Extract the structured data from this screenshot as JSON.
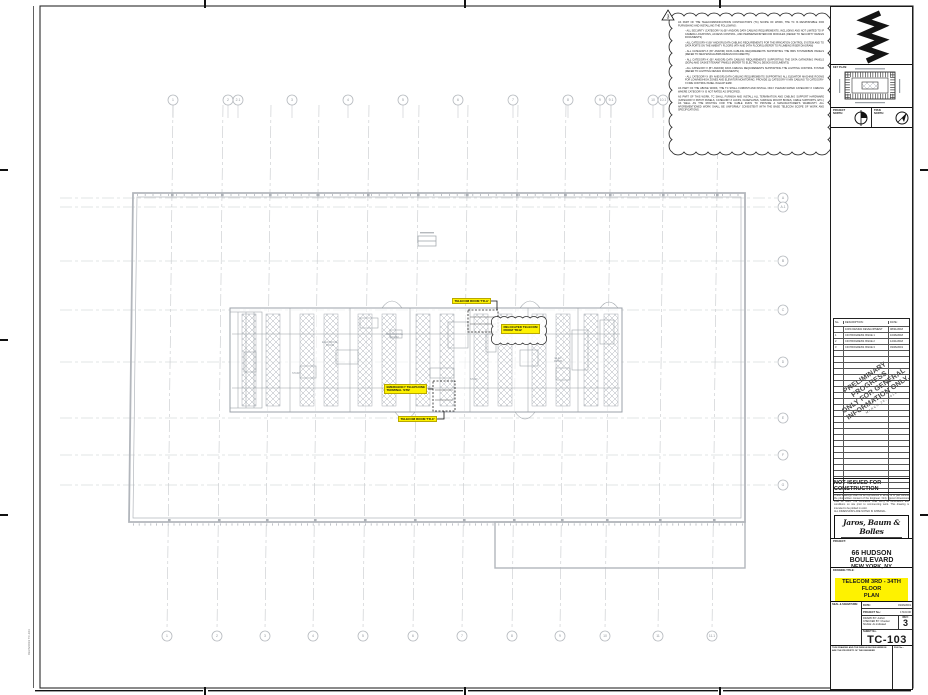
{
  "sheet": {
    "project_label": "PROJECT:",
    "project_name": "66 HUDSON BOULEVARD",
    "project_location": "NEW YORK, NY",
    "drawing_title_label": "DRAWING TITLE:",
    "drawing_title": "TELECOM 3RD - 34TH FLOOR\nPLAN",
    "sheet_no_label": "SHEET No.",
    "sheet_no": "TC-103",
    "rev_label": "REV:",
    "rev": "3",
    "date_label": "DATE:",
    "date_value": "03/26/2019",
    "project_no_label": "PROJECT No.:",
    "project_no_value": "17103.00",
    "drawn_line": "DRAWN BY: Author",
    "checked_line": "CHECKED BY: Checker",
    "scale_line": "SCALE: As indicated",
    "seal_label": "SEAL & SIGNATURE:",
    "not_issued": "NOT ISSUED FOR CONSTRUCTION",
    "disclaimer": "These drawings shall not be reproduced in whole or in part without the prior written consent of the Engineer. Only figured dimensions shall be used. The Contractor shall verify all dimensions and conditions on site prior to commencing work. This drawing is intended to be plotted in color.\nALL DIMENSIONS ARE NOTED IN IMPERIAL.",
    "key_plan_label": "KEY PLAN:",
    "project_north_label": "PROJECT\nNORTH:",
    "true_north_label": "TRUE\nNORTH:",
    "footer_left": "THIS DRAWING AND THE DESIGN SHOWN HEREON ARE THE PROPERTY OF THE ENGINEER",
    "footer_right": "FILE No.:",
    "plot_stamp": "03/26/2019  TC-103"
  },
  "engineer": {
    "name": "Jaros, Baum & Bolles",
    "line2": "CONSULTING ENGINEERS",
    "line3": "NEW YORK, NY"
  },
  "revision_table": {
    "headers": [
      "No.",
      "DESCRIPTION:",
      "DATE:"
    ],
    "rows": [
      [
        "",
        "100% DESIGN DEVELOPMENT",
        "08/31/2018"
      ],
      [
        "1",
        "CD PROGRESS ISSUE 1",
        "10/26/2018"
      ],
      [
        "2",
        "CD PROGRESS ISSUE 2",
        "12/21/2018"
      ],
      [
        "3",
        "CD PROGRESS ISSUE 3",
        "03/26/2019"
      ]
    ],
    "empty_row_count": 25
  },
  "watermark": {
    "lines": [
      "PRELIMINARY PROGRESS",
      "ONLY FOR GENERAL",
      "INFORMATION ONLY."
    ],
    "subline": "MARCH 26, 2019"
  },
  "cloud_note": {
    "delta": "3",
    "paragraphs": [
      "AS PART OF THE TELECOMMUNICATIONS CONTRACTOR'S (TC) SCOPE OF WORK, THE TC IS RESPONSIBLE FOR FURNISHING AND INSTALLING THE FOLLOWING:",
      "-  ALL SECURITY (CATEGORY-X) (BY AND/OR) DATA CABLING REQUIREMENTS, INCLUDING AND NOT LIMITED TO IP CAMERA LOCATIONS, ACCESS CONTROL, AND PERIMETER/INTERCOM MODULES (REFER TO SECURITY DESIGN DOCUMENTS)",
      "-  ALL CATEGORY-X (BY AND/OR) DATA CABLING REQUIREMENTS FOR THE IRRIGATION CONTROL SYSTEM AND TO DATA PORTS ON THE AMENITY FLOORS (4TH AND 34TH FLOORS) (REFER TO PLUMBING RISER DIAGRAM)",
      "-  ALL CATEGORY-X (BY AND/OR) DATA CABLING REQUIREMENTS SUPPORTING THE BMS SYSTEM/BMS PANELS (REFER TO MECHANICAL/BMS DESIGN DOCUMENTS)",
      "-  ALL CATEGORY-X (BY AND/OR) DATA CABLING REQUIREMENTS SUPPORTING THE DATA GATHERING PANELS (DGPs) AND GASKET/TENANT PANELS (REFER TO ELECTRICAL DESIGN DOCUMENTS)",
      "-  ALL CATEGORY-X (BY AND/OR) DATA CABLING REQUIREMENTS SUPPORTING THE LIGHTING CONTROL SYSTEM (REFER TO LIGHTING DESIGN DOCUMENTS)",
      "-  ALL CATEGORY-X (BY AND/OR) DATA CABLING REQUIREMENTS SUPPORTING ALL ELEVATOR MACHINE ROOMS FOR LOW/MID/HIGH ZONES AND ELEVATOR MONITORING. PROVIDE (1) CATEGORY-X MIN CABLING TO CATEGORY-X FIRE CONTROL PANEL IN EACH EMR.",
      "AS PART OF THE ABOVE WORK, THE TC SHALL FURNISH AND INSTALL ONLY PLENUM RATED CATEGORY-X CABLING WHERE CATEGORY-X IS NOT RATED AS SPECIFIED.",
      "AS PART OF THIS WORK, TC SHALL FURNISH AND INSTALL ALL TERMINATION AND CABLING SUPPORT HARDWARE (CATEGORY-X PATCH PANELS, CATEGORY-X JACKS, FACEPLATES, SURFACE MOUNT BOXES, CABLE SUPPORTS, ETC.) AS WELL AS THE ROUTING FOR THE CABLE RUNS TO PROVIDE A MANUFACTURER'S WARRANTY. ALL AFOREMENTIONED WORK SHALL BE UNIFORMLY CONSISTENT WITH THE BASE TELECOM SCOPE OF WORK AND SPECIFICATIONS."
    ]
  },
  "callouts": [
    {
      "text": "TELECOM ROOM 'TR-A'",
      "x": 452,
      "y": 298
    },
    {
      "text": "RELOCATED TELECOM\nROOM 'TR-B'",
      "x": 501,
      "y": 324
    },
    {
      "text": "EMERGENCY TELEPHONE\nTERMINAL 'ETB'",
      "x": 384,
      "y": 384
    },
    {
      "text": "TELECOM ROOM 'TR-C'",
      "x": 398,
      "y": 416
    }
  ],
  "plan": {
    "room_labels": [
      {
        "text": "ELECTRICAL\nROOM",
        "x": 330,
        "y": 344
      },
      {
        "text": "MECHANICAL\nROOM",
        "x": 394,
        "y": 336
      },
      {
        "text": "ELEC\nROOM",
        "x": 560,
        "y": 360
      },
      {
        "text": "STAIR",
        "x": 296,
        "y": 374
      },
      {
        "text": "STAIR",
        "x": 474,
        "y": 380
      }
    ]
  },
  "plan_grid": {
    "top_bubbles": {
      "y": 100,
      "items": [
        {
          "x": 173,
          "label": "1"
        },
        {
          "x": 228,
          "label": "2"
        },
        {
          "x": 238,
          "label": "2.1"
        },
        {
          "x": 292,
          "label": "3"
        },
        {
          "x": 348,
          "label": "4"
        },
        {
          "x": 403,
          "label": "5"
        },
        {
          "x": 458,
          "label": "6"
        },
        {
          "x": 513,
          "label": "7"
        },
        {
          "x": 568,
          "label": "8"
        },
        {
          "x": 600,
          "label": "9"
        },
        {
          "x": 611,
          "label": "9.1"
        },
        {
          "x": 653,
          "label": "10"
        },
        {
          "x": 663,
          "label": "10.1"
        }
      ]
    },
    "bottom_bubbles": {
      "y": 636,
      "items": [
        {
          "x": 167,
          "label": "1"
        },
        {
          "x": 217,
          "label": "2"
        },
        {
          "x": 265,
          "label": "3"
        },
        {
          "x": 313,
          "label": "4"
        },
        {
          "x": 363,
          "label": "5"
        },
        {
          "x": 413,
          "label": "6"
        },
        {
          "x": 462,
          "label": "7"
        },
        {
          "x": 512,
          "label": "8"
        },
        {
          "x": 560,
          "label": "9"
        },
        {
          "x": 605,
          "label": "10"
        },
        {
          "x": 658,
          "label": "11"
        },
        {
          "x": 712,
          "label": "11.1"
        }
      ]
    },
    "right_bubbles": {
      "x": 783,
      "items": [
        {
          "y": 198,
          "label": "A"
        },
        {
          "y": 207,
          "label": "A.1"
        },
        {
          "y": 261,
          "label": "B"
        },
        {
          "y": 310,
          "label": "C"
        },
        {
          "y": 362,
          "label": "D"
        },
        {
          "y": 418,
          "label": "E"
        },
        {
          "y": 455,
          "label": "F"
        },
        {
          "y": 485,
          "label": "G"
        }
      ]
    }
  },
  "colors": {
    "highlight": "#fef200",
    "plan_line": "#b2b6bc",
    "grid_line": "#c6c9cc",
    "core_line": "#9ba1a8"
  }
}
